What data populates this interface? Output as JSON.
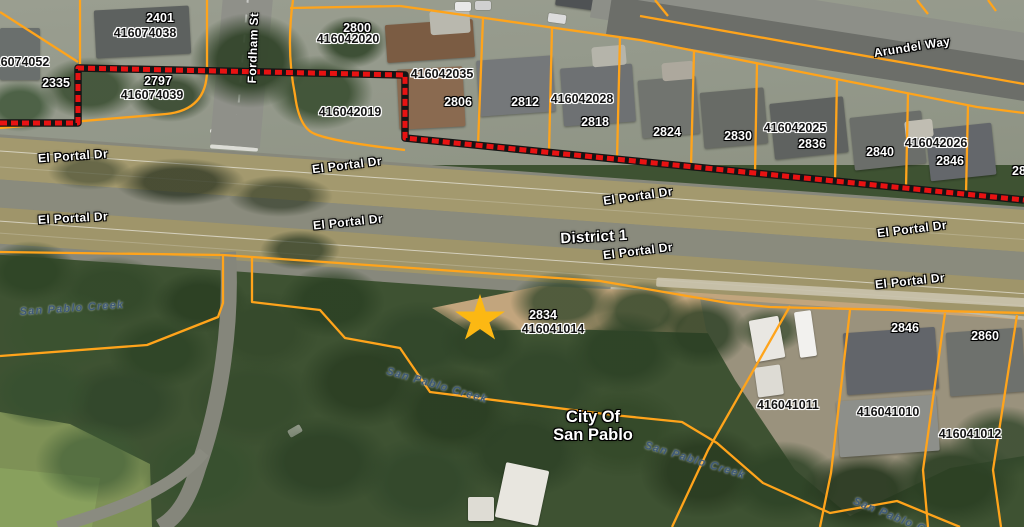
{
  "map": {
    "colors": {
      "parcel_line": "#FFA41B",
      "boundary_red": "#E81212",
      "boundary_casing": "#151515",
      "star_gold": "#FCB813",
      "creek_text": "#3F5A77"
    },
    "district_label": {
      "text": "District 1",
      "x": 594,
      "y": 237,
      "rot": -3
    },
    "city_label": {
      "line1": "City Of",
      "line2": "San Pablo"
    },
    "street_labels": [
      {
        "text": "El Portal Dr",
        "x": 73,
        "y": 156,
        "rot": -4
      },
      {
        "text": "El Portal Dr",
        "x": 347,
        "y": 165,
        "rot": -7
      },
      {
        "text": "El Portal Dr",
        "x": 73,
        "y": 218,
        "rot": -3
      },
      {
        "text": "El Portal Dr",
        "x": 348,
        "y": 222,
        "rot": -6
      },
      {
        "text": "El Portal Dr",
        "x": 638,
        "y": 196,
        "rot": -8
      },
      {
        "text": "El Portal Dr",
        "x": 638,
        "y": 251,
        "rot": -7
      },
      {
        "text": "El Portal Dr",
        "x": 912,
        "y": 229,
        "rot": -7
      },
      {
        "text": "El Portal Dr",
        "x": 910,
        "y": 281,
        "rot": -6
      },
      {
        "text": "Arundel Way",
        "x": 912,
        "y": 47,
        "rot": -9
      },
      {
        "text": "Fordham St",
        "x": 253,
        "y": 48,
        "rot": -88
      }
    ],
    "parcel_number_labels": [
      {
        "text": "2401",
        "x": 160,
        "y": 18
      },
      {
        "text": "2335",
        "x": 56,
        "y": 83
      },
      {
        "text": "2797",
        "x": 158,
        "y": 81
      },
      {
        "text": "2800",
        "x": 357,
        "y": 28
      },
      {
        "text": "2806",
        "x": 458,
        "y": 102
      },
      {
        "text": "2812",
        "x": 525,
        "y": 102
      },
      {
        "text": "2818",
        "x": 595,
        "y": 122
      },
      {
        "text": "2824",
        "x": 667,
        "y": 132
      },
      {
        "text": "2830",
        "x": 738,
        "y": 136
      },
      {
        "text": "2836",
        "x": 812,
        "y": 144
      },
      {
        "text": "2840",
        "x": 880,
        "y": 152
      },
      {
        "text": "2846",
        "x": 950,
        "y": 161
      },
      {
        "text": "28",
        "x": 1019,
        "y": 171
      },
      {
        "text": "2834",
        "x": 543,
        "y": 315
      },
      {
        "text": "2846",
        "x": 905,
        "y": 328
      },
      {
        "text": "2860",
        "x": 985,
        "y": 336
      }
    ],
    "apn_labels": [
      {
        "text": "416074052",
        "x": 18,
        "y": 62
      },
      {
        "text": "416074038",
        "x": 145,
        "y": 33
      },
      {
        "text": "416074039",
        "x": 152,
        "y": 95
      },
      {
        "text": "416042020",
        "x": 348,
        "y": 39
      },
      {
        "text": "416042035",
        "x": 442,
        "y": 74
      },
      {
        "text": "416042019",
        "x": 350,
        "y": 112
      },
      {
        "text": "416042028",
        "x": 582,
        "y": 99
      },
      {
        "text": "416042025",
        "x": 795,
        "y": 128
      },
      {
        "text": "416042026",
        "x": 936,
        "y": 143
      },
      {
        "text": "416041014",
        "x": 553,
        "y": 329
      },
      {
        "text": "416041011",
        "x": 788,
        "y": 405
      },
      {
        "text": "416041010",
        "x": 888,
        "y": 412
      },
      {
        "text": "416041012",
        "x": 970,
        "y": 434
      }
    ],
    "creek_labels": [
      {
        "text": "San Pablo Creek",
        "x": 72,
        "y": 309,
        "rot": -4
      },
      {
        "text": "San Pablo Creek",
        "x": 437,
        "y": 386,
        "rot": 16
      },
      {
        "text": "San Pablo Creek",
        "x": 695,
        "y": 461,
        "rot": 17
      },
      {
        "text": "San Pablo Creek",
        "x": 902,
        "y": 521,
        "rot": 22
      }
    ],
    "star_marker": {
      "x": 480,
      "y": 319,
      "size": 52
    },
    "boundary_path": "M0,123 L78,123 L78,68 L405,75 L405,138 L1024,200",
    "parcel_line_paths": [
      "M0,12 L78,62",
      "M80,0 L80,64",
      "M207,0 L207,70 Q207,110 166,114 L0,128",
      "M293,0 Q286,50 295,95 Q299,128 315,134 Q335,142 405,150",
      "M290,8 L400,6",
      "M400,6 L640,40 L977,107 L1024,113",
      "M483,18 L478,145",
      "M552,28 L549,152",
      "M620,37 L617,159",
      "M694,51 L691,167",
      "M757,63 L755,173",
      "M837,79 L835,181",
      "M908,93 L906,188",
      "M968,105 L966,194",
      "M640,16 L1024,84",
      "M655,0 L668,16",
      "M917,0 L928,14",
      "M988,0 L996,11",
      "M0,252 L223,255 L252,257 L455,271 L600,281 L728,303 L770,307 L1024,313",
      "M223,255 L223,303 L218,317 L147,345 L0,356",
      "M252,257 L252,302 L320,310 L345,338 L400,348 L430,392 L613,415 L682,422 L717,443 L763,483 L830,513 L897,501 L960,527",
      "M790,306 L708,450 L672,527",
      "M850,310 L831,473 L820,527",
      "M945,313 L923,470 L928,527",
      "M1017,315 L993,470 L1001,527"
    ]
  }
}
